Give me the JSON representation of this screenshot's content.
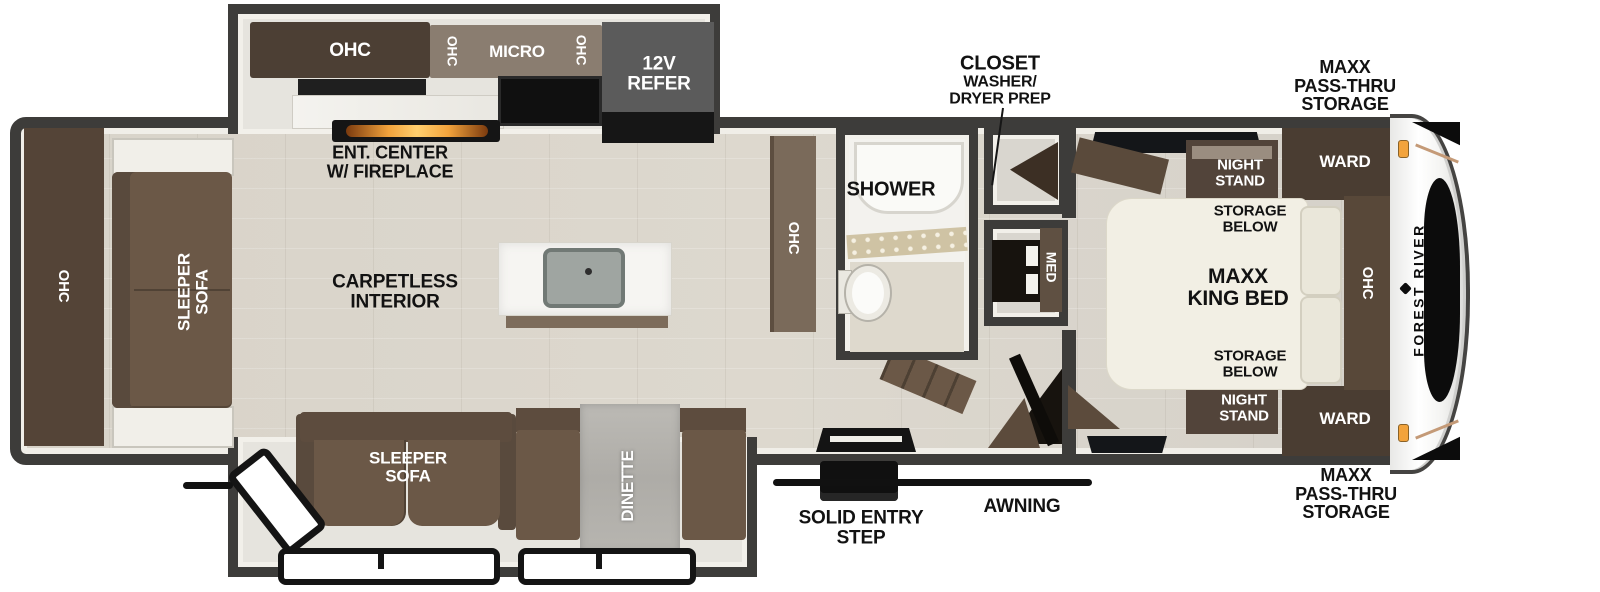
{
  "brand": "FOREST RIVER",
  "kitchen": {
    "ohc": "OHC",
    "ohc_left": "OHC",
    "micro": "MICRO",
    "ohc_right": "OHC",
    "refer": "12V\nREFER",
    "ent_center": "ENT. CENTER\nW/ FIREPLACE"
  },
  "living": {
    "carpetless": "CARPETLESS\nINTERIOR",
    "rear_ohc": "OHC",
    "rear_sleeper_sofa": "SLEEPER\nSOFA"
  },
  "slideout_bottom": {
    "sleeper_sofa": "SLEEPER\nSOFA",
    "dinette": "DINETTE"
  },
  "bath": {
    "shower": "SHOWER",
    "med": "MED",
    "hall_ohc": "OHC"
  },
  "closet": {
    "title": "CLOSET",
    "subtitle": "WASHER/\nDRYER PREP"
  },
  "bedroom": {
    "night_stand_top": "NIGHT\nSTAND",
    "night_stand_bottom": "NIGHT\nSTAND",
    "storage_below_top": "STORAGE\nBELOW",
    "storage_below_bottom": "STORAGE\nBELOW",
    "king_bed": "MAXX\nKING BED",
    "ohc": "OHC",
    "ward_top": "WARD",
    "ward_bottom": "WARD"
  },
  "exterior": {
    "storage_top": "MAXX\nPASS-THRU\nSTORAGE",
    "storage_bottom": "MAXX\nPASS-THRU\nSTORAGE",
    "awning": "AWNING",
    "entry_step": "SOLID ENTRY\nSTEP"
  },
  "colors": {
    "wall": "#3d3c3a",
    "cabinet_dark": "#4c3f34",
    "sofa_brown": "#6b5847",
    "floor": "#d8d3c9",
    "counter_white": "#f5f4f1",
    "fireplace_glow": "#f2a33c",
    "marker_light": "#f2a33c"
  }
}
